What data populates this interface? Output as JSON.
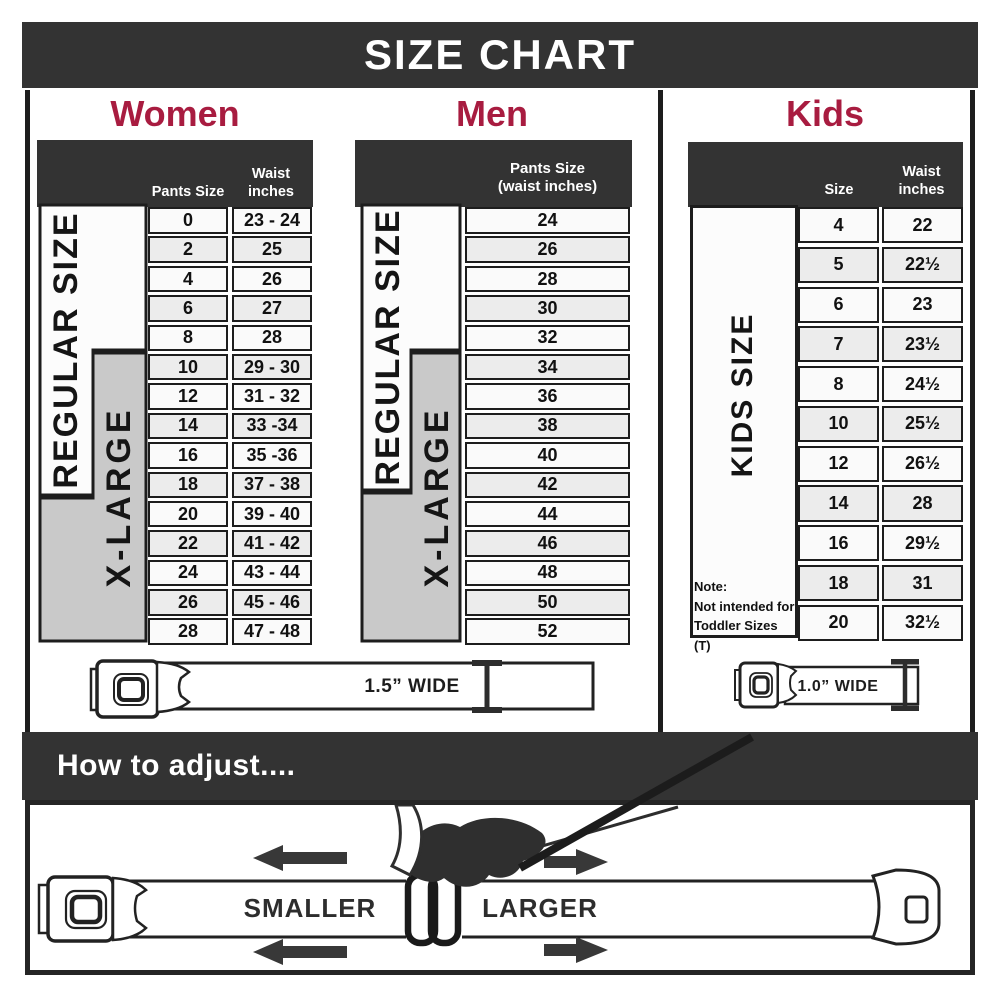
{
  "title": "SIZE CHART",
  "colors": {
    "accent": "#a81c40",
    "band": "#333333",
    "xlarge_bg": "#c9c9c9"
  },
  "women": {
    "heading": "Women",
    "regular_label": "REGULAR SIZE",
    "xlarge_label": "X-LARGE",
    "col1_header": "Pants Size",
    "col2_header_line1": "Waist",
    "col2_header_line2": "inches",
    "rows": [
      {
        "size": "0",
        "waist": "23 - 24"
      },
      {
        "size": "2",
        "waist": "25"
      },
      {
        "size": "4",
        "waist": "26"
      },
      {
        "size": "6",
        "waist": "27"
      },
      {
        "size": "8",
        "waist": "28"
      },
      {
        "size": "10",
        "waist": "29 - 30"
      },
      {
        "size": "12",
        "waist": "31 - 32"
      },
      {
        "size": "14",
        "waist": "33 -34"
      },
      {
        "size": "16",
        "waist": "35 -36"
      },
      {
        "size": "18",
        "waist": "37 - 38"
      },
      {
        "size": "20",
        "waist": "39 - 40"
      },
      {
        "size": "22",
        "waist": "41 - 42"
      },
      {
        "size": "24",
        "waist": "43 - 44"
      },
      {
        "size": "26",
        "waist": "45 - 46"
      },
      {
        "size": "28",
        "waist": "47 - 48"
      }
    ]
  },
  "men": {
    "heading": "Men",
    "regular_label": "REGULAR SIZE",
    "xlarge_label": "X-LARGE",
    "col_header_line1": "Pants Size",
    "col_header_line2": "(waist inches)",
    "rows": [
      "24",
      "26",
      "28",
      "30",
      "32",
      "34",
      "36",
      "38",
      "40",
      "42",
      "44",
      "46",
      "48",
      "50",
      "52"
    ]
  },
  "kids": {
    "heading": "Kids",
    "side_label": "KIDS SIZE",
    "col1_header": "Size",
    "col2_header_line1": "Waist",
    "col2_header_line2": "inches",
    "note_line1": "Note:",
    "note_line2": "Not intended for",
    "note_line3": "Toddler Sizes (T)",
    "rows": [
      {
        "size": "4",
        "waist": "22"
      },
      {
        "size": "5",
        "waist": "22½"
      },
      {
        "size": "6",
        "waist": "23"
      },
      {
        "size": "7",
        "waist": "23½"
      },
      {
        "size": "8",
        "waist": "24½"
      },
      {
        "size": "10",
        "waist": "25½"
      },
      {
        "size": "12",
        "waist": "26½"
      },
      {
        "size": "14",
        "waist": "28"
      },
      {
        "size": "16",
        "waist": "29½"
      },
      {
        "size": "18",
        "waist": "31"
      },
      {
        "size": "20",
        "waist": "32½"
      }
    ]
  },
  "belts": {
    "adult_width_label": "1.5” WIDE",
    "kids_width_label": "1.0” WIDE"
  },
  "adjust": {
    "heading": "How to adjust....",
    "smaller_label": "SMALLER",
    "larger_label": "LARGER"
  },
  "chart_data": [
    {
      "type": "table",
      "title": "Women",
      "columns": [
        "Pants Size",
        "Waist inches"
      ],
      "rows": [
        [
          "0",
          "23 - 24"
        ],
        [
          "2",
          "25"
        ],
        [
          "4",
          "26"
        ],
        [
          "6",
          "27"
        ],
        [
          "8",
          "28"
        ],
        [
          "10",
          "29 - 30"
        ],
        [
          "12",
          "31 - 32"
        ],
        [
          "14",
          "33 -34"
        ],
        [
          "16",
          "35 -36"
        ],
        [
          "18",
          "37 - 38"
        ],
        [
          "20",
          "39 - 40"
        ],
        [
          "22",
          "41 - 42"
        ],
        [
          "24",
          "43 - 44"
        ],
        [
          "26",
          "45 - 46"
        ],
        [
          "28",
          "47 - 48"
        ]
      ],
      "annotations": [
        "REGULAR SIZE covers pants sizes 0-18",
        "X-LARGE covers pants sizes 10-28",
        "Belt is 1.5” WIDE"
      ]
    },
    {
      "type": "table",
      "title": "Men",
      "columns": [
        "Pants Size (waist inches)"
      ],
      "rows": [
        [
          "24"
        ],
        [
          "26"
        ],
        [
          "28"
        ],
        [
          "30"
        ],
        [
          "32"
        ],
        [
          "34"
        ],
        [
          "36"
        ],
        [
          "38"
        ],
        [
          "40"
        ],
        [
          "42"
        ],
        [
          "44"
        ],
        [
          "46"
        ],
        [
          "48"
        ],
        [
          "50"
        ],
        [
          "52"
        ]
      ],
      "annotations": [
        "REGULAR SIZE covers waist 24-42",
        "X-LARGE covers waist 34-52",
        "Belt is 1.5” WIDE"
      ]
    },
    {
      "type": "table",
      "title": "Kids",
      "columns": [
        "Size",
        "Waist inches"
      ],
      "rows": [
        [
          "4",
          "22"
        ],
        [
          "5",
          "22½"
        ],
        [
          "6",
          "23"
        ],
        [
          "7",
          "23½"
        ],
        [
          "8",
          "24½"
        ],
        [
          "10",
          "25½"
        ],
        [
          "12",
          "26½"
        ],
        [
          "14",
          "28"
        ],
        [
          "16",
          "29½"
        ],
        [
          "18",
          "31"
        ],
        [
          "20",
          "32½"
        ]
      ],
      "annotations": [
        "KIDS SIZE",
        "Note: Not intended for Toddler Sizes (T)",
        "Belt is 1.0” WIDE"
      ]
    }
  ]
}
